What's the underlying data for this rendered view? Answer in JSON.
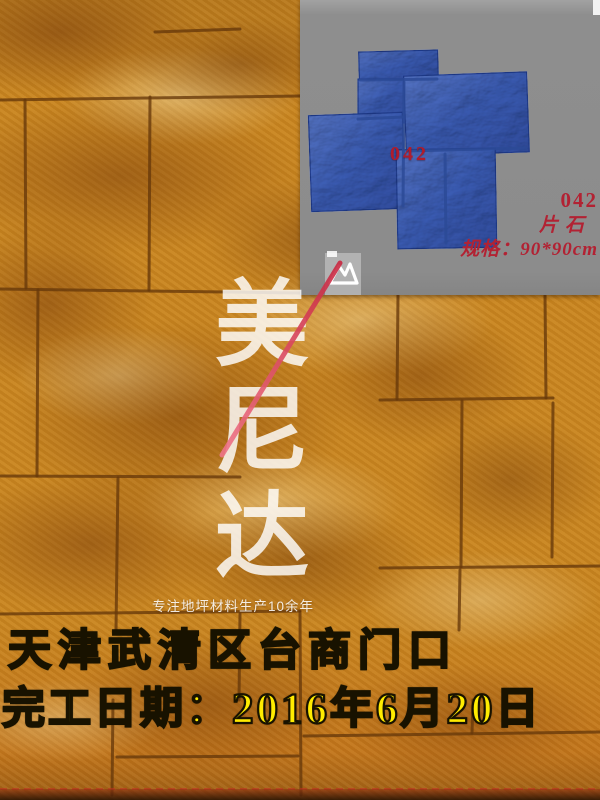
{
  "photo": {
    "subject": "yellow stamped-concrete slate-pattern floor",
    "base_color": "#c9851f",
    "grout_color": "#66380a"
  },
  "inset": {
    "background_color": "#8c8c8c",
    "mold": {
      "number": "042",
      "blue_color": "#5b7cc4"
    },
    "label": {
      "model": "042",
      "name": "片石",
      "spec": "规格：90*90cm",
      "color": "#b22233"
    }
  },
  "watermark": {
    "chars": [
      "美",
      "尼",
      "达"
    ],
    "tagline": "专注地坪材料生产10余年",
    "logo_icon": "mountain-logo-icon",
    "accent_line_color": "#d6394f"
  },
  "caption": {
    "line1": "天津武清区台商门口",
    "line2": "完工日期：2016年6月20日",
    "color": "#ffec00"
  }
}
